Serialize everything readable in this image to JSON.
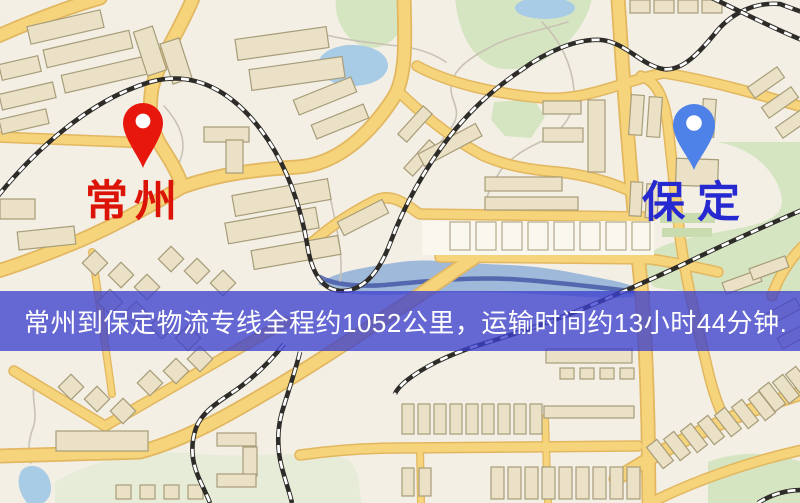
{
  "banner": {
    "text": "常州到保定物流专线全程约1052公里，运输时间约13小时44分钟."
  },
  "map": {
    "origin": {
      "name": "常州"
    },
    "destination": {
      "name": "保定"
    }
  },
  "colors": {
    "map-bg": "#f3efe5",
    "banner-bg": "rgba(60,64,205,0.78)",
    "banner-text": "#ffffff",
    "pin-origin": "#e8170d",
    "pin-dest": "#4f82e8",
    "label-origin": "#dc1407",
    "label-dest": "#2628d0",
    "road": "#f5d47c",
    "road-casing": "#e2b760",
    "building": "#eae1c6",
    "building-outline": "#a89d79",
    "building-light": "#faf7ef",
    "green": "#d5e5c1",
    "green-pale": "#e7ecd9",
    "water": "#a8cbe6",
    "river": "#9fb9da",
    "river-channel": "#3a4da0",
    "railway": "#2e2c29",
    "path-gray": "#c9c2b4"
  }
}
